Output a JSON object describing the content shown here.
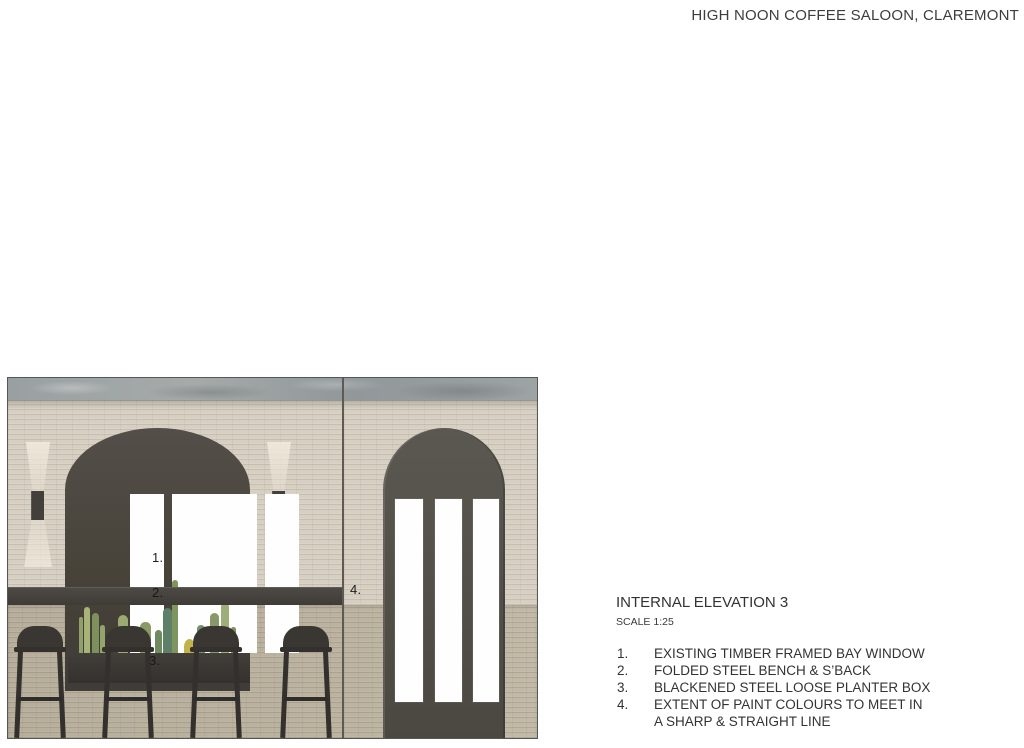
{
  "sheet": {
    "project_title": "HIGH NOON COFFEE SALOON, CLAREMONT"
  },
  "elevation": {
    "title": "INTERNAL ELEVATION 3",
    "scale": "SCALE 1:25",
    "notes": [
      {
        "num": "1.",
        "text": "EXISTING TIMBER FRAMED BAY WINDOW"
      },
      {
        "num": "2.",
        "text": "FOLDED STEEL BENCH & S’BACK"
      },
      {
        "num": "3.",
        "text": "BLACKENED STEEL LOOSE PLANTER BOX"
      },
      {
        "num": "4.",
        "text": "EXTENT OF PAINT COLOURS TO MEET IN\nA SHARP & STRAIGHT LINE"
      }
    ]
  },
  "drawing": {
    "callouts": {
      "c1": "1.",
      "c2": "2.",
      "c3": "3.",
      "c4": "4."
    },
    "palette": {
      "upper_wall": "#d6cfc2",
      "lower_wall": "#bab19f",
      "concrete_lintel": "#9ca1a2",
      "charcoal_frame": "#474339",
      "bench_steel": "#44413c",
      "door_grey": "#534f49",
      "stool_black": "#3a3733",
      "glass_pane": "#fefefe",
      "cactus_green": "#8a9a63",
      "cactus_yellow": "#bfb34a",
      "sconce_light": "#f0e9db"
    }
  }
}
